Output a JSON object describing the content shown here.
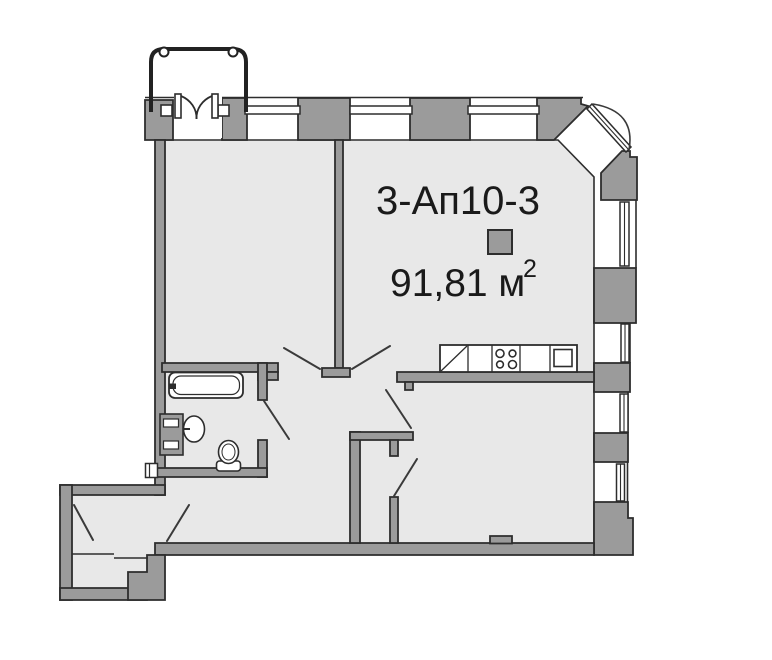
{
  "plan": {
    "apartment_code": "3-Ап10-3",
    "area_value": "91,81 м",
    "area_superscript": "2"
  },
  "legend": {
    "square_color": "#9b9b9b"
  },
  "colors": {
    "background": "#ffffff",
    "wall_fill": "#9b9b9b",
    "wall_outline": "#2d2d2d",
    "floor_fill": "#e8e8e8",
    "fixture_fill": "#ffffff",
    "door_swing_line": "#3a3a3a",
    "text": "#1a1a1a"
  },
  "fixtures": {
    "bathtub": "bathtub",
    "washbasin": "washbasin",
    "toilet": "toilet",
    "kitchen_counter": "kitchen-counter",
    "stove": "stove-4-burners",
    "kitchen_sink": "kitchen-sink",
    "balcony_railing": "balcony-railing",
    "utility_box": "utility-meter"
  }
}
